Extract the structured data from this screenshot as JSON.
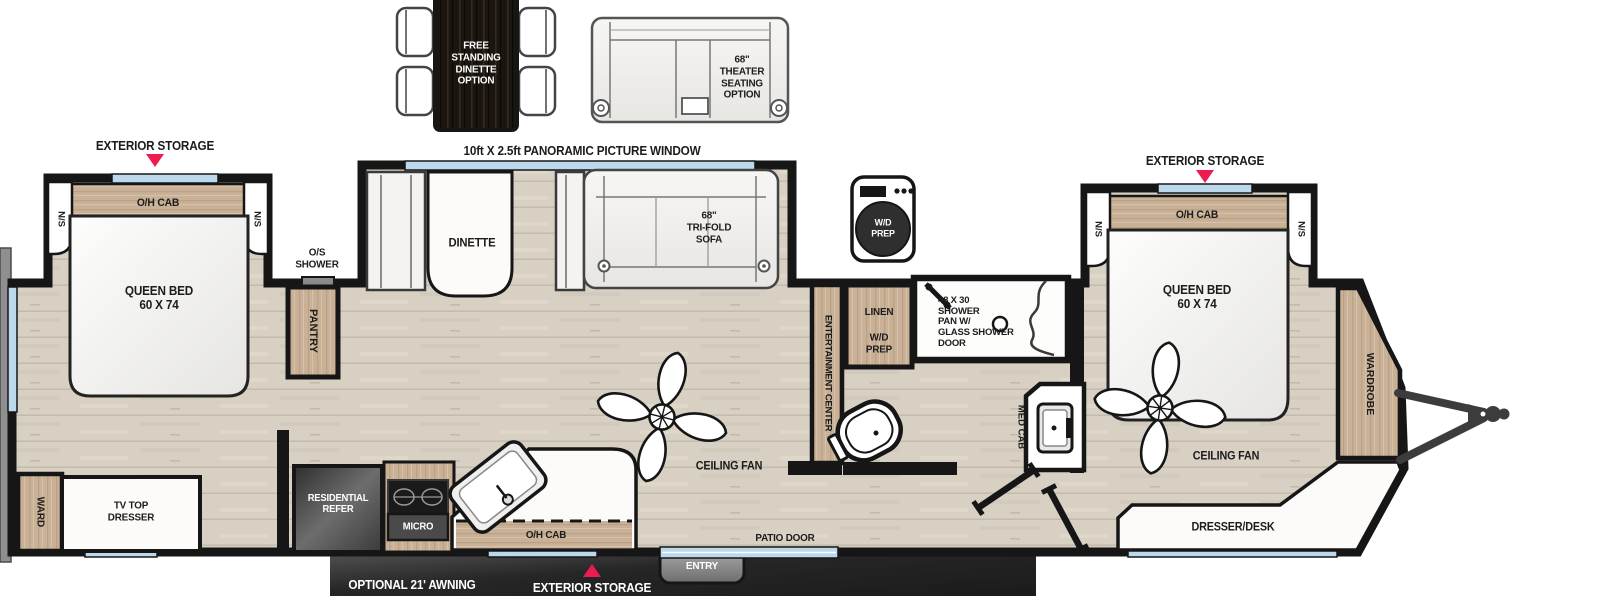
{
  "colors": {
    "wall": "#161616",
    "floor_wood": "#d7d0c3",
    "cabinet_wood": "#c9b197",
    "dark_wood": "#1a150f",
    "window_blue": "#bcd9ec",
    "accent_red": "#ee1c4e",
    "awning_bar_dark": "#1d1d1d",
    "marble": "#fcfbf9"
  },
  "top_options": {
    "free_standing_dinette": "FREE\nSTANDING\nDINETTE\nOPTION",
    "theater_seating": "68\"\nTHEATER\nSEATING\nOPTION"
  },
  "callouts": {
    "exterior_storage_left": "EXTERIOR STORAGE",
    "exterior_storage_right": "EXTERIOR STORAGE",
    "exterior_storage_bottom": "EXTERIOR STORAGE",
    "panoramic_window": "10ft X 2.5ft PANORAMIC PICTURE WINDOW",
    "awning": "OPTIONAL 21' AWNING",
    "os_shower": "O/S\nSHOWER"
  },
  "bedroom_rear": {
    "overhead_cabinet": "O/H CAB",
    "nightstand_left": "N/S",
    "nightstand_right": "N/S",
    "bed": "QUEEN BED\n60 X 74",
    "pantry": "PANTRY",
    "wardrobe": "WARD",
    "tv_dresser": "TV TOP\nDRESSER"
  },
  "living_area": {
    "dinette": "DINETTE",
    "sofa": "68\"\nTRI-FOLD\nSOFA",
    "ceiling_fan": "CEILING FAN",
    "entertainment_center": "ENTERTAINMENT CENTER",
    "patio_door": "PATIO DOOR",
    "entry": "ENTRY"
  },
  "kitchen": {
    "refrigerator": "RESIDENTIAL\nREFER",
    "microwave": "MICRO",
    "overhead_cabinet": "O/H CAB"
  },
  "bathroom": {
    "washer_prep": "W/D\nPREP",
    "linen": "LINEN",
    "linen_wd_prep": "W/D\nPREP",
    "shower": "48 X 30\nSHOWER\nPAN W/\nGLASS SHOWER\nDOOR",
    "med_cab": "MED CAB"
  },
  "bedroom_front": {
    "overhead_cabinet": "O/H CAB",
    "nightstand_left": "N/S",
    "nightstand_right": "N/S",
    "bed": "QUEEN BED\n60 X 74",
    "ceiling_fan": "CEILING FAN",
    "wardrobe": "WARDROBE",
    "dresser_desk": "DRESSER/DESK"
  }
}
